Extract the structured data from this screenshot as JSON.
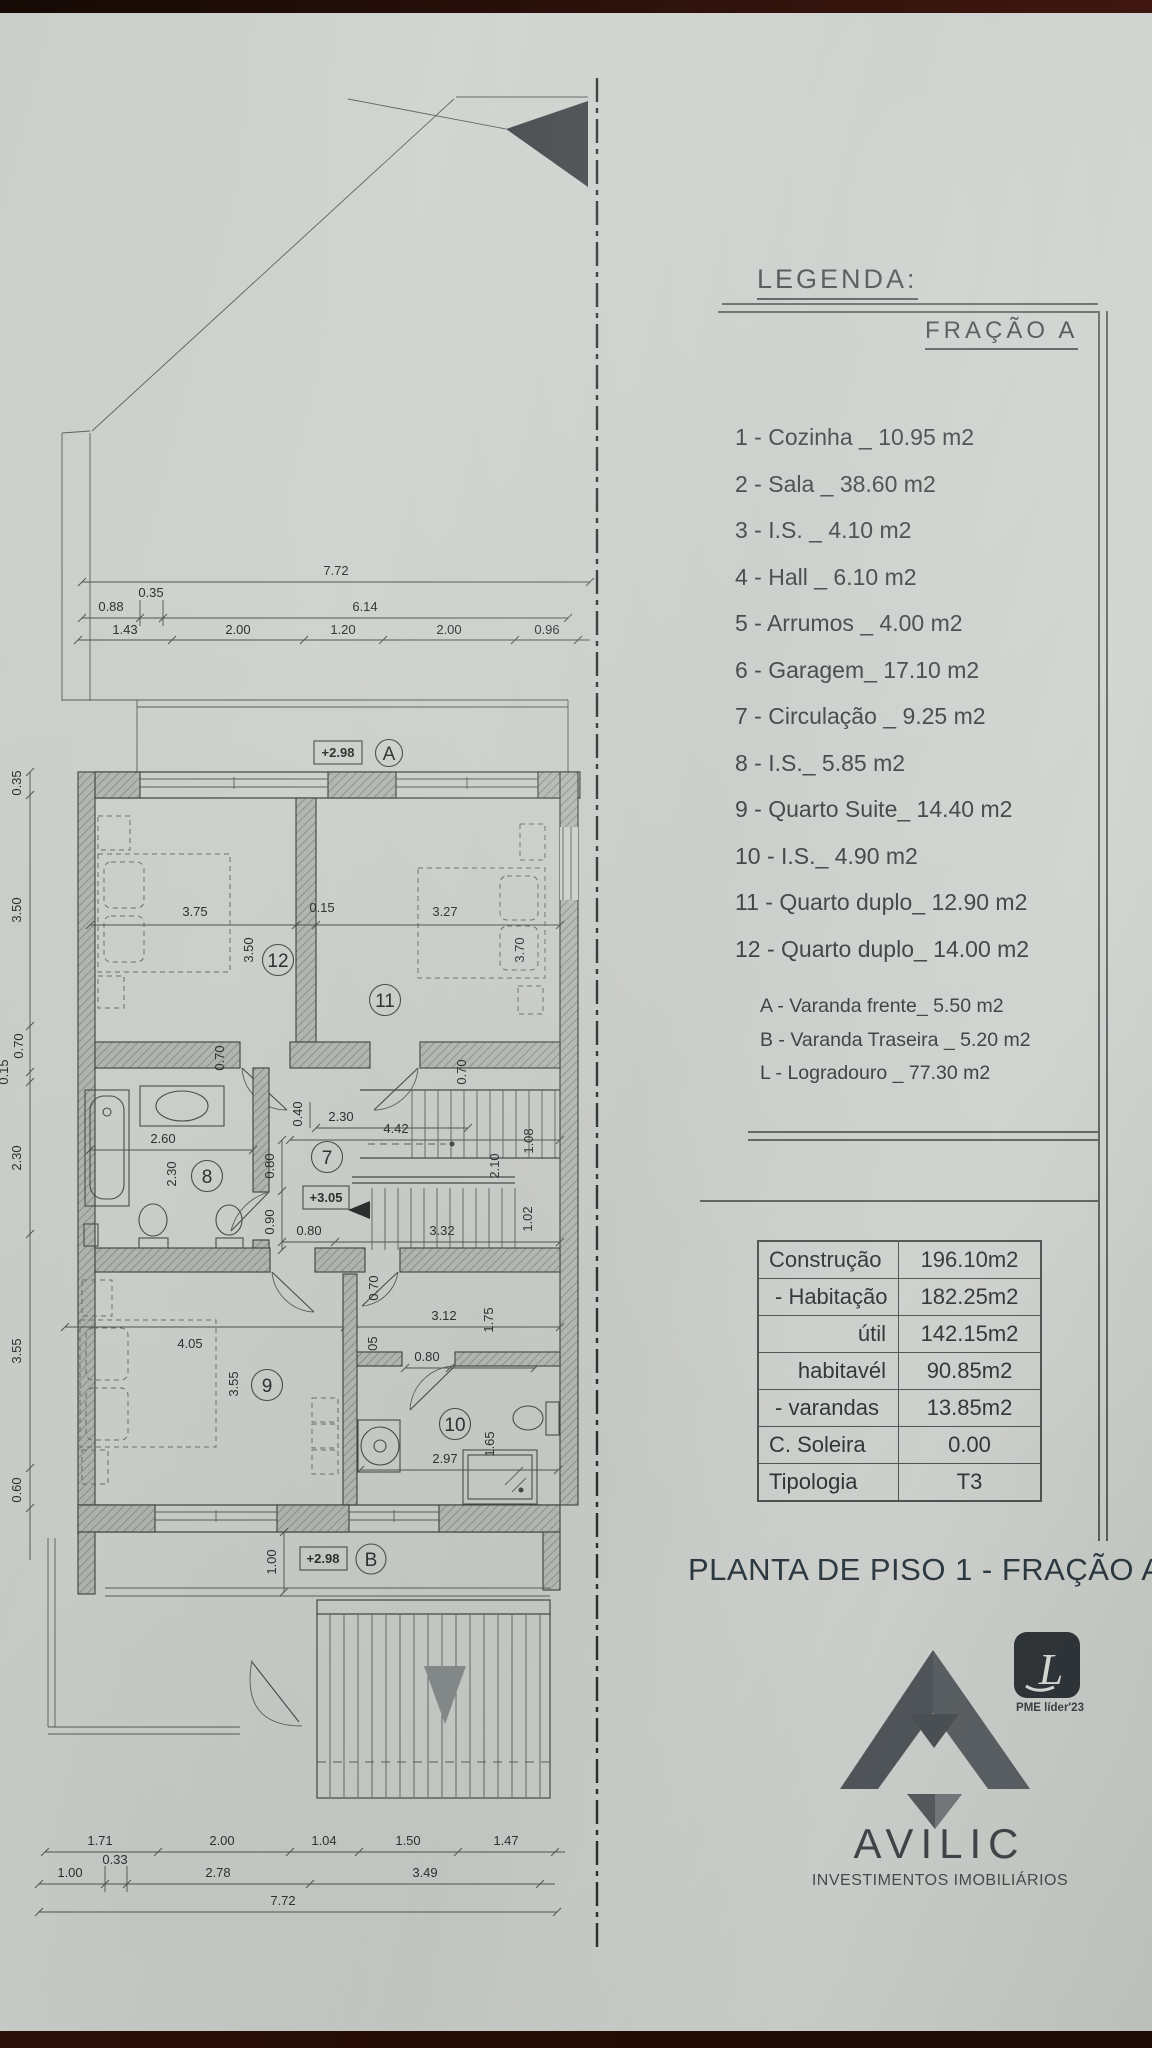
{
  "legend": {
    "title": "LEGENDA:",
    "fraction_title": "FRAÇÃO A",
    "items": [
      "1 - Cozinha _ 10.95 m2",
      "2 - Sala _ 38.60 m2",
      "3 - I.S. _ 4.10 m2",
      "4 - Hall _ 6.10 m2",
      "5 - Arrumos _ 4.00 m2",
      "6 - Garagem_ 17.10 m2",
      "7 - Circulação _ 9.25 m2",
      "8 - I.S._ 5.85 m2",
      "9 - Quarto Suite_ 14.40 m2",
      "10 - I.S._ 4.90 m2",
      "11 - Quarto duplo_ 12.90 m2",
      "12 - Quarto duplo_ 14.00 m2"
    ],
    "sub_items": [
      "A - Varanda frente_ 5.50 m2",
      "B - Varanda Traseira _ 5.20 m2",
      "L - Logradouro _ 77.30 m2"
    ]
  },
  "areas_table": {
    "rows": [
      {
        "label": "Construção",
        "value": "196.10m2"
      },
      {
        "label": "- Habitação",
        "value": "182.25m2"
      },
      {
        "label": "útil",
        "value": "142.15m2"
      },
      {
        "label": "habitavél",
        "value": "90.85m2"
      },
      {
        "label": "- varandas",
        "value": "13.85m2"
      },
      {
        "label": "C. Soleira",
        "value": "0.00"
      },
      {
        "label": "Tipologia",
        "value": "T3"
      }
    ]
  },
  "drawing_title": "PLANTA DE PISO 1 - FRAÇÃO A",
  "logo": {
    "name": "AVILIC",
    "tagline": "INVESTIMENTOS IMOBILIÁRIOS",
    "badge": "PME líder'23",
    "badge_letter": "L"
  },
  "plan": {
    "level_a": "+2.98",
    "level_mid": "+3.05",
    "level_b": "+2.98",
    "circles": {
      "a": "A",
      "b": "B",
      "n7": "7",
      "n8": "8",
      "n9": "9",
      "n10": "10",
      "n11": "11",
      "n12": "12"
    },
    "dims": {
      "top_total": "7.72",
      "t088": "0.88",
      "t035": "0.35",
      "t614": "6.14",
      "t143": "1.43",
      "t200a": "2.00",
      "t120": "1.20",
      "t200b": "2.00",
      "t096": "0.96",
      "l035": "0.35",
      "l350": "3.50",
      "l070": "0.70",
      "l015": "0.15",
      "l230": "2.30",
      "l355": "3.55",
      "l060": "0.60",
      "r375": "3.75",
      "r015": "0.15",
      "r327": "3.27",
      "r350": "3.50",
      "r370": "3.70",
      "r070a": "0.70",
      "r070b": "0.70",
      "m260": "2.60",
      "m230": "2.30",
      "m040": "0.40",
      "m230h": "2.30",
      "m442": "4.42",
      "m080v": "0.80",
      "m090": "0.90",
      "m080h": "0.80",
      "m332": "3.32",
      "m108": "1.08",
      "m210": "2.10",
      "m102": "1.02",
      "s070": "0.70",
      "s312": "3.12",
      "s175": "1.75",
      "s105": "1.05",
      "s080": "0.80",
      "s145": "1.45",
      "s405": "4.05",
      "s355": "3.55",
      "s297": "2.97",
      "s165": "1.65",
      "s100": "1.00",
      "b171": "1.71",
      "b200a": "2.00",
      "b104": "1.04",
      "b150": "1.50",
      "b147": "1.47",
      "b100": "1.00",
      "b033": "0.33",
      "b278": "2.78",
      "b349": "3.49",
      "b772": "7.72"
    }
  }
}
